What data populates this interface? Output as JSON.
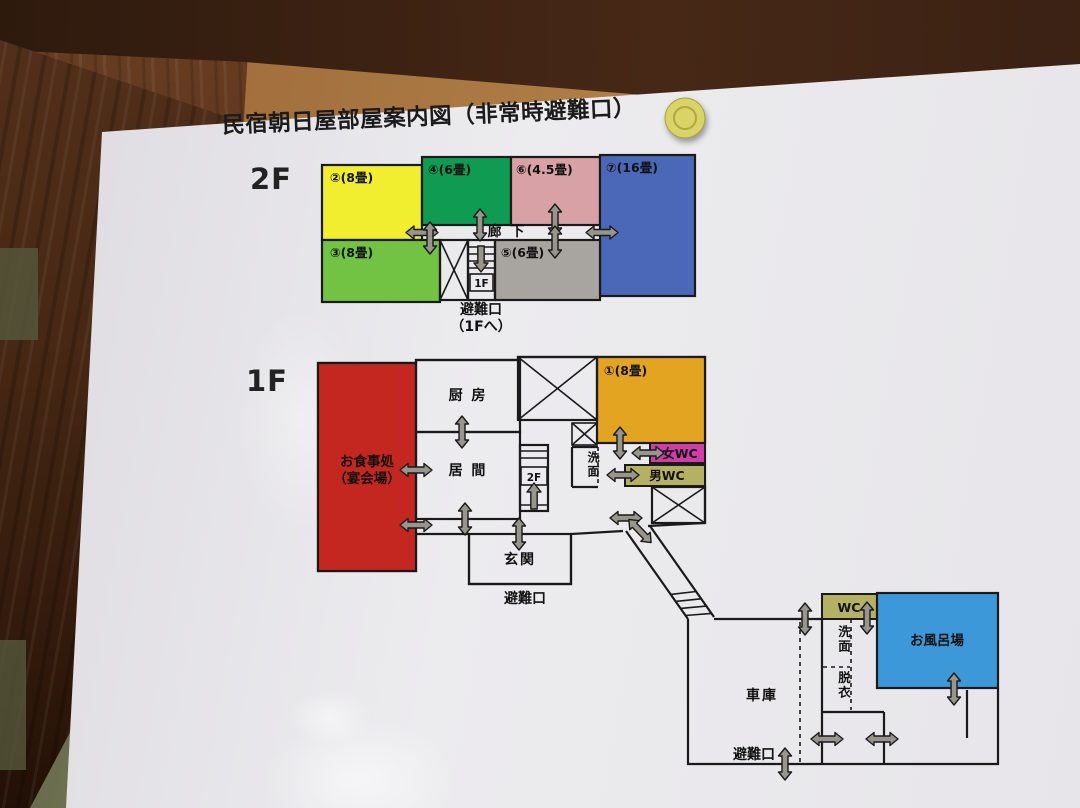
{
  "title": "民宿朝日屋部屋案内図（非常時避難口）",
  "floor2": {
    "label": "2F",
    "rooms": {
      "r2": "②(8畳)",
      "r4": "④(6畳)",
      "r6": "⑥(4.5畳)",
      "r7": "⑦(16畳)",
      "r3": "③(8畳)",
      "r5": "⑤(6畳)"
    },
    "corridor": "廊 下",
    "stair_to": "1F",
    "exit": "避難口",
    "exit_note": "（1Fへ）"
  },
  "floor1": {
    "label": "1F",
    "dining_line1": "お食事処",
    "dining_line2": "（宴会場）",
    "kitchen": "厨 房",
    "living": "居 間",
    "room1": "①(8畳)",
    "washroom": "洗面",
    "wc_women": "女WC",
    "wc_men": "男WC",
    "entrance": "玄関",
    "stair_to": "2F",
    "exit": "避難口",
    "annex": {
      "garage": "車庫",
      "wc": "WC",
      "washroom": "洗面",
      "dressing": "脱衣",
      "bath": "お風呂場",
      "exit": "避難口"
    }
  },
  "colors": {
    "room2": "#f0ee2f",
    "room4": "#0f9b52",
    "room6": "#d8a1a6",
    "room7": "#4b68b8",
    "room3": "#72c244",
    "room5": "#a8a5a0",
    "dining": "#c4271f",
    "room1": "#e2a421",
    "wc_women": "#cf3da6",
    "wc_men": "#b5b163",
    "annex_wc": "#b5b163",
    "bath": "#3c98d8",
    "exit_text": "#cc1111",
    "pin": "#d9d465"
  }
}
